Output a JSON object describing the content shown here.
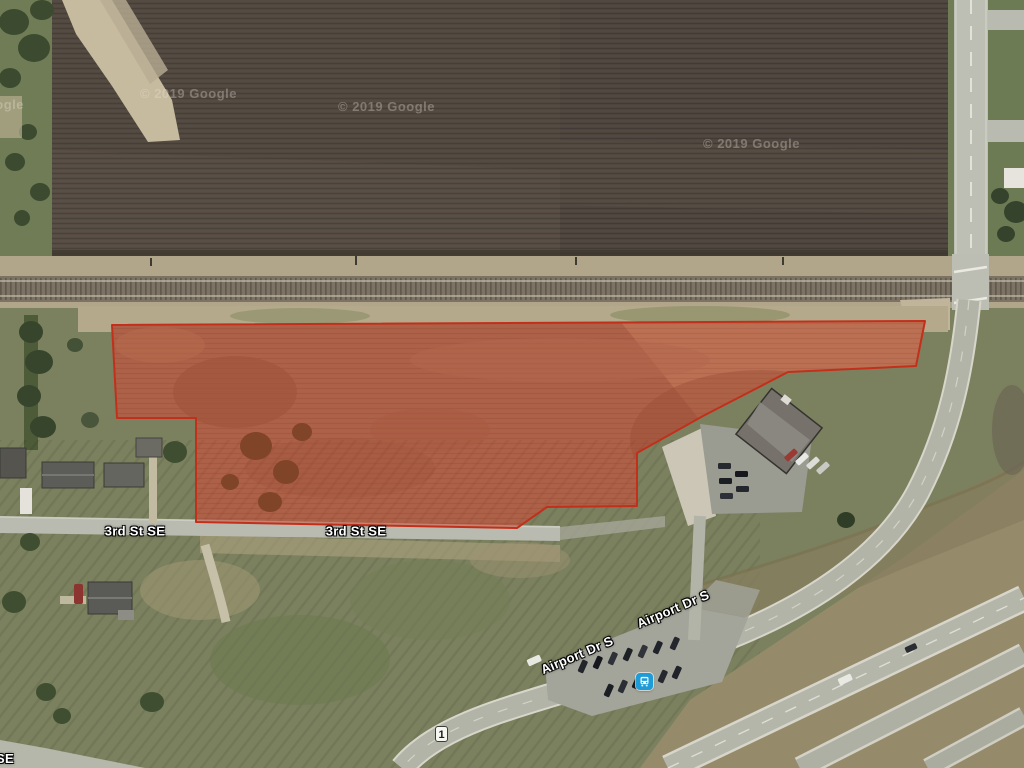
{
  "map": {
    "street_labels": {
      "third_st_a": "3rd St SE",
      "third_st_b": "3rd St SE",
      "airport_dr_a": "Airport Dr S",
      "airport_dr_b": "Airport Dr S",
      "edge_partial": "SE"
    },
    "route_shield": {
      "number": "1"
    },
    "attribution": {
      "w_left": "© 2019 Google",
      "w_mid_left": "© 2019 Google",
      "w_mid": "© 2019 Google",
      "w_right": "© 2019 Google"
    },
    "icons": {
      "transit": "bus-station"
    },
    "overlay": {
      "parcel_fill": "rgba(193,57,34,0.5)",
      "parcel_stroke": "#c2301c"
    },
    "colors": {
      "transit_blue": "#1E9CD8",
      "plowed_field": "#4E463E",
      "grass_olive": "#7B815E",
      "road_gray": "#B4B6AA"
    }
  }
}
